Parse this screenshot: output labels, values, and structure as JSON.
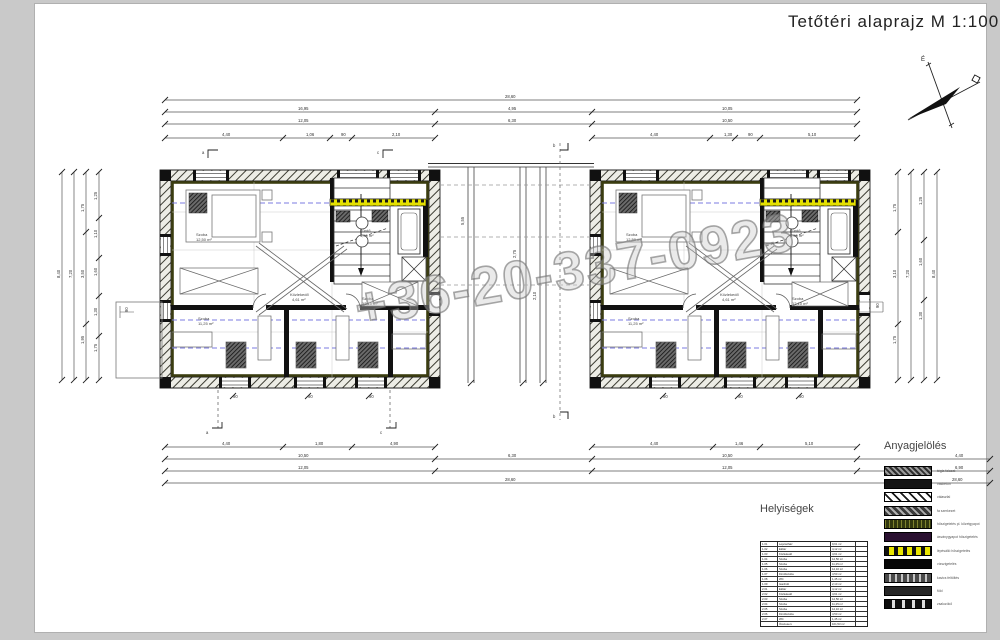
{
  "page": {
    "title": "Tetőtéri alaprajz  M  1:100"
  },
  "watermark": "+36-20-337-0923",
  "compass": {
    "north_label": "É"
  },
  "legend": {
    "title": "Anyagjelölés",
    "items": [
      {
        "label": "tégla falazat",
        "swatch": "sw1"
      },
      {
        "label": "vasbeton",
        "swatch": "sw2"
      },
      {
        "label": "válaszfal",
        "swatch": "sw3"
      },
      {
        "label": "fa szerkezet",
        "swatch": "sw4"
      },
      {
        "label": "hőszigetelés pl. kőzetgyapot",
        "swatch": "sw5"
      },
      {
        "label": "ásványgyapot hőszigetelés",
        "swatch": "sw6"
      },
      {
        "label": "lépésálló hőszigetelés",
        "swatch": "sw7"
      },
      {
        "label": "vízszigetelés",
        "swatch": "sw8"
      },
      {
        "label": "kavics feltöltés",
        "swatch": "sw9"
      },
      {
        "label": "föld",
        "swatch": "sw10"
      },
      {
        "label": "zsaluzókő",
        "swatch": "sw11"
      }
    ]
  },
  "rooms_table": {
    "title": "Helyiségek",
    "rows": [
      [
        "1.01",
        "Lépcsőház",
        "9,61 m²",
        ""
      ],
      [
        "1.02",
        "Előtér",
        "4,12 m²",
        ""
      ],
      [
        "1.03",
        "Közlekedő",
        "4,61 m²",
        ""
      ],
      [
        "1.04",
        "Szoba",
        "12,50 m²",
        ""
      ],
      [
        "1.05",
        "Szoba",
        "11,25 m²",
        ""
      ],
      [
        "1.06",
        "Szoba",
        "12,10 m²",
        ""
      ],
      [
        "1.07",
        "Fürdőszoba",
        "4,50 m²",
        ""
      ],
      [
        "1.08",
        "WC",
        "1,45 m²",
        ""
      ],
      [
        "1.09",
        "Gardrób",
        "2,10 m²",
        ""
      ],
      [
        "2.01",
        "Előtér",
        "4,12 m²",
        ""
      ],
      [
        "2.02",
        "Közlekedő",
        "4,61 m²",
        ""
      ],
      [
        "2.03",
        "Szoba",
        "12,50 m²",
        ""
      ],
      [
        "2.04",
        "Szoba",
        "11,25 m²",
        ""
      ],
      [
        "2.05",
        "Szoba",
        "12,10 m²",
        ""
      ],
      [
        "2.06",
        "Fürdőszoba",
        "4,50 m²",
        ""
      ],
      [
        "2.07",
        "WC",
        "1,45 m²",
        ""
      ],
      [
        "",
        "Összesen:",
        "101,53 m²",
        ""
      ]
    ]
  },
  "plan": {
    "dim_labels": [
      {
        "t": "28,60",
        "x": 505,
        "y": 98
      },
      {
        "t": "16,95",
        "x": 298,
        "y": 110
      },
      {
        "t": "4,95",
        "x": 508,
        "y": 110
      },
      {
        "t": "10,05",
        "x": 722,
        "y": 110
      },
      {
        "t": "12,05",
        "x": 298,
        "y": 122
      },
      {
        "t": "6,30",
        "x": 508,
        "y": 122
      },
      {
        "t": "10,50",
        "x": 722,
        "y": 122
      },
      {
        "t": "4,40",
        "x": 222,
        "y": 136
      },
      {
        "t": "1,06",
        "x": 306,
        "y": 136
      },
      {
        "t": "90",
        "x": 341,
        "y": 136
      },
      {
        "t": "2,10",
        "x": 392,
        "y": 136
      },
      {
        "t": "4,40",
        "x": 650,
        "y": 136
      },
      {
        "t": "1,30",
        "x": 724,
        "y": 136
      },
      {
        "t": "90",
        "x": 748,
        "y": 136
      },
      {
        "t": "5,10",
        "x": 808,
        "y": 136
      },
      {
        "t": "4,40",
        "x": 222,
        "y": 445
      },
      {
        "t": "1,80",
        "x": 315,
        "y": 445
      },
      {
        "t": "4,90",
        "x": 390,
        "y": 445
      },
      {
        "t": "4,40",
        "x": 650,
        "y": 445
      },
      {
        "t": "1,46",
        "x": 735,
        "y": 445
      },
      {
        "t": "5,10",
        "x": 805,
        "y": 445
      },
      {
        "t": "10,50",
        "x": 298,
        "y": 457
      },
      {
        "t": "6,30",
        "x": 508,
        "y": 457
      },
      {
        "t": "10,50",
        "x": 722,
        "y": 457
      },
      {
        "t": "4,40",
        "x": 955,
        "y": 457
      },
      {
        "t": "12,05",
        "x": 298,
        "y": 469
      },
      {
        "t": "12,05",
        "x": 722,
        "y": 469
      },
      {
        "t": "6,90",
        "x": 955,
        "y": 469
      },
      {
        "t": "28,60",
        "x": 505,
        "y": 481
      },
      {
        "t": "28,60",
        "x": 952,
        "y": 481
      },
      {
        "t": "8,40",
        "x": 60,
        "y": 278,
        "r": -90
      },
      {
        "t": "7,20",
        "x": 72,
        "y": 278,
        "r": -90
      },
      {
        "t": "1,75",
        "x": 84,
        "y": 212,
        "r": -90
      },
      {
        "t": "3,50",
        "x": 84,
        "y": 278,
        "r": -90
      },
      {
        "t": "1,95",
        "x": 84,
        "y": 344,
        "r": -90
      },
      {
        "t": "1,25",
        "x": 97,
        "y": 200,
        "r": -90
      },
      {
        "t": "1,10",
        "x": 97,
        "y": 238,
        "r": -90
      },
      {
        "t": "1,60",
        "x": 97,
        "y": 276,
        "r": -90
      },
      {
        "t": "1,30",
        "x": 97,
        "y": 316,
        "r": -90
      },
      {
        "t": "1,75",
        "x": 97,
        "y": 352,
        "r": -90
      },
      {
        "t": "1,75",
        "x": 896,
        "y": 212,
        "r": -90
      },
      {
        "t": "3,10",
        "x": 896,
        "y": 278,
        "r": -90
      },
      {
        "t": "1,75",
        "x": 896,
        "y": 344,
        "r": -90
      },
      {
        "t": "7,20",
        "x": 909,
        "y": 278,
        "r": -90
      },
      {
        "t": "1,25",
        "x": 922,
        "y": 205,
        "r": -90
      },
      {
        "t": "1,60",
        "x": 922,
        "y": 266,
        "r": -90
      },
      {
        "t": "1,30",
        "x": 922,
        "y": 320,
        "r": -90
      },
      {
        "t": "8,40",
        "x": 935,
        "y": 278,
        "r": -90
      },
      {
        "t": "5,55",
        "x": 464,
        "y": 225,
        "r": -90
      },
      {
        "t": "2,75",
        "x": 516,
        "y": 258,
        "r": -90
      },
      {
        "t": "2,10",
        "x": 536,
        "y": 300,
        "r": -90
      },
      {
        "t": "a",
        "x": 202,
        "y": 154
      },
      {
        "t": "c",
        "x": 377,
        "y": 154
      },
      {
        "t": "b",
        "x": 553,
        "y": 147
      },
      {
        "t": "a",
        "x": 206,
        "y": 434
      },
      {
        "t": "c",
        "x": 380,
        "y": 434
      },
      {
        "t": "b",
        "x": 553,
        "y": 418
      },
      {
        "t": "90",
        "x": 233,
        "y": 398
      },
      {
        "t": "90",
        "x": 308,
        "y": 398
      },
      {
        "t": "90",
        "x": 369,
        "y": 398
      },
      {
        "t": "90",
        "x": 663,
        "y": 398
      },
      {
        "t": "90",
        "x": 738,
        "y": 398
      },
      {
        "t": "90",
        "x": 799,
        "y": 398
      },
      {
        "t": "90",
        "x": 879,
        "y": 308,
        "r": -90
      },
      {
        "t": "90",
        "x": 128,
        "y": 312,
        "r": -90
      }
    ],
    "room_labels": [
      {
        "t": "Szoba",
        "x": 196,
        "y": 236
      },
      {
        "t": "12,50 m²",
        "x": 196,
        "y": 241
      },
      {
        "t": "Közlekedő",
        "x": 290,
        "y": 296
      },
      {
        "t": "4,61 m²",
        "x": 292,
        "y": 301
      },
      {
        "t": "Fürdő",
        "x": 360,
        "y": 232
      },
      {
        "t": "4,50 m²",
        "x": 360,
        "y": 237
      },
      {
        "t": "Szoba",
        "x": 198,
        "y": 320
      },
      {
        "t": "11,25 m²",
        "x": 198,
        "y": 325
      },
      {
        "t": "Szoba",
        "x": 362,
        "y": 300
      },
      {
        "t": "12,10 m²",
        "x": 362,
        "y": 305
      }
    ]
  }
}
